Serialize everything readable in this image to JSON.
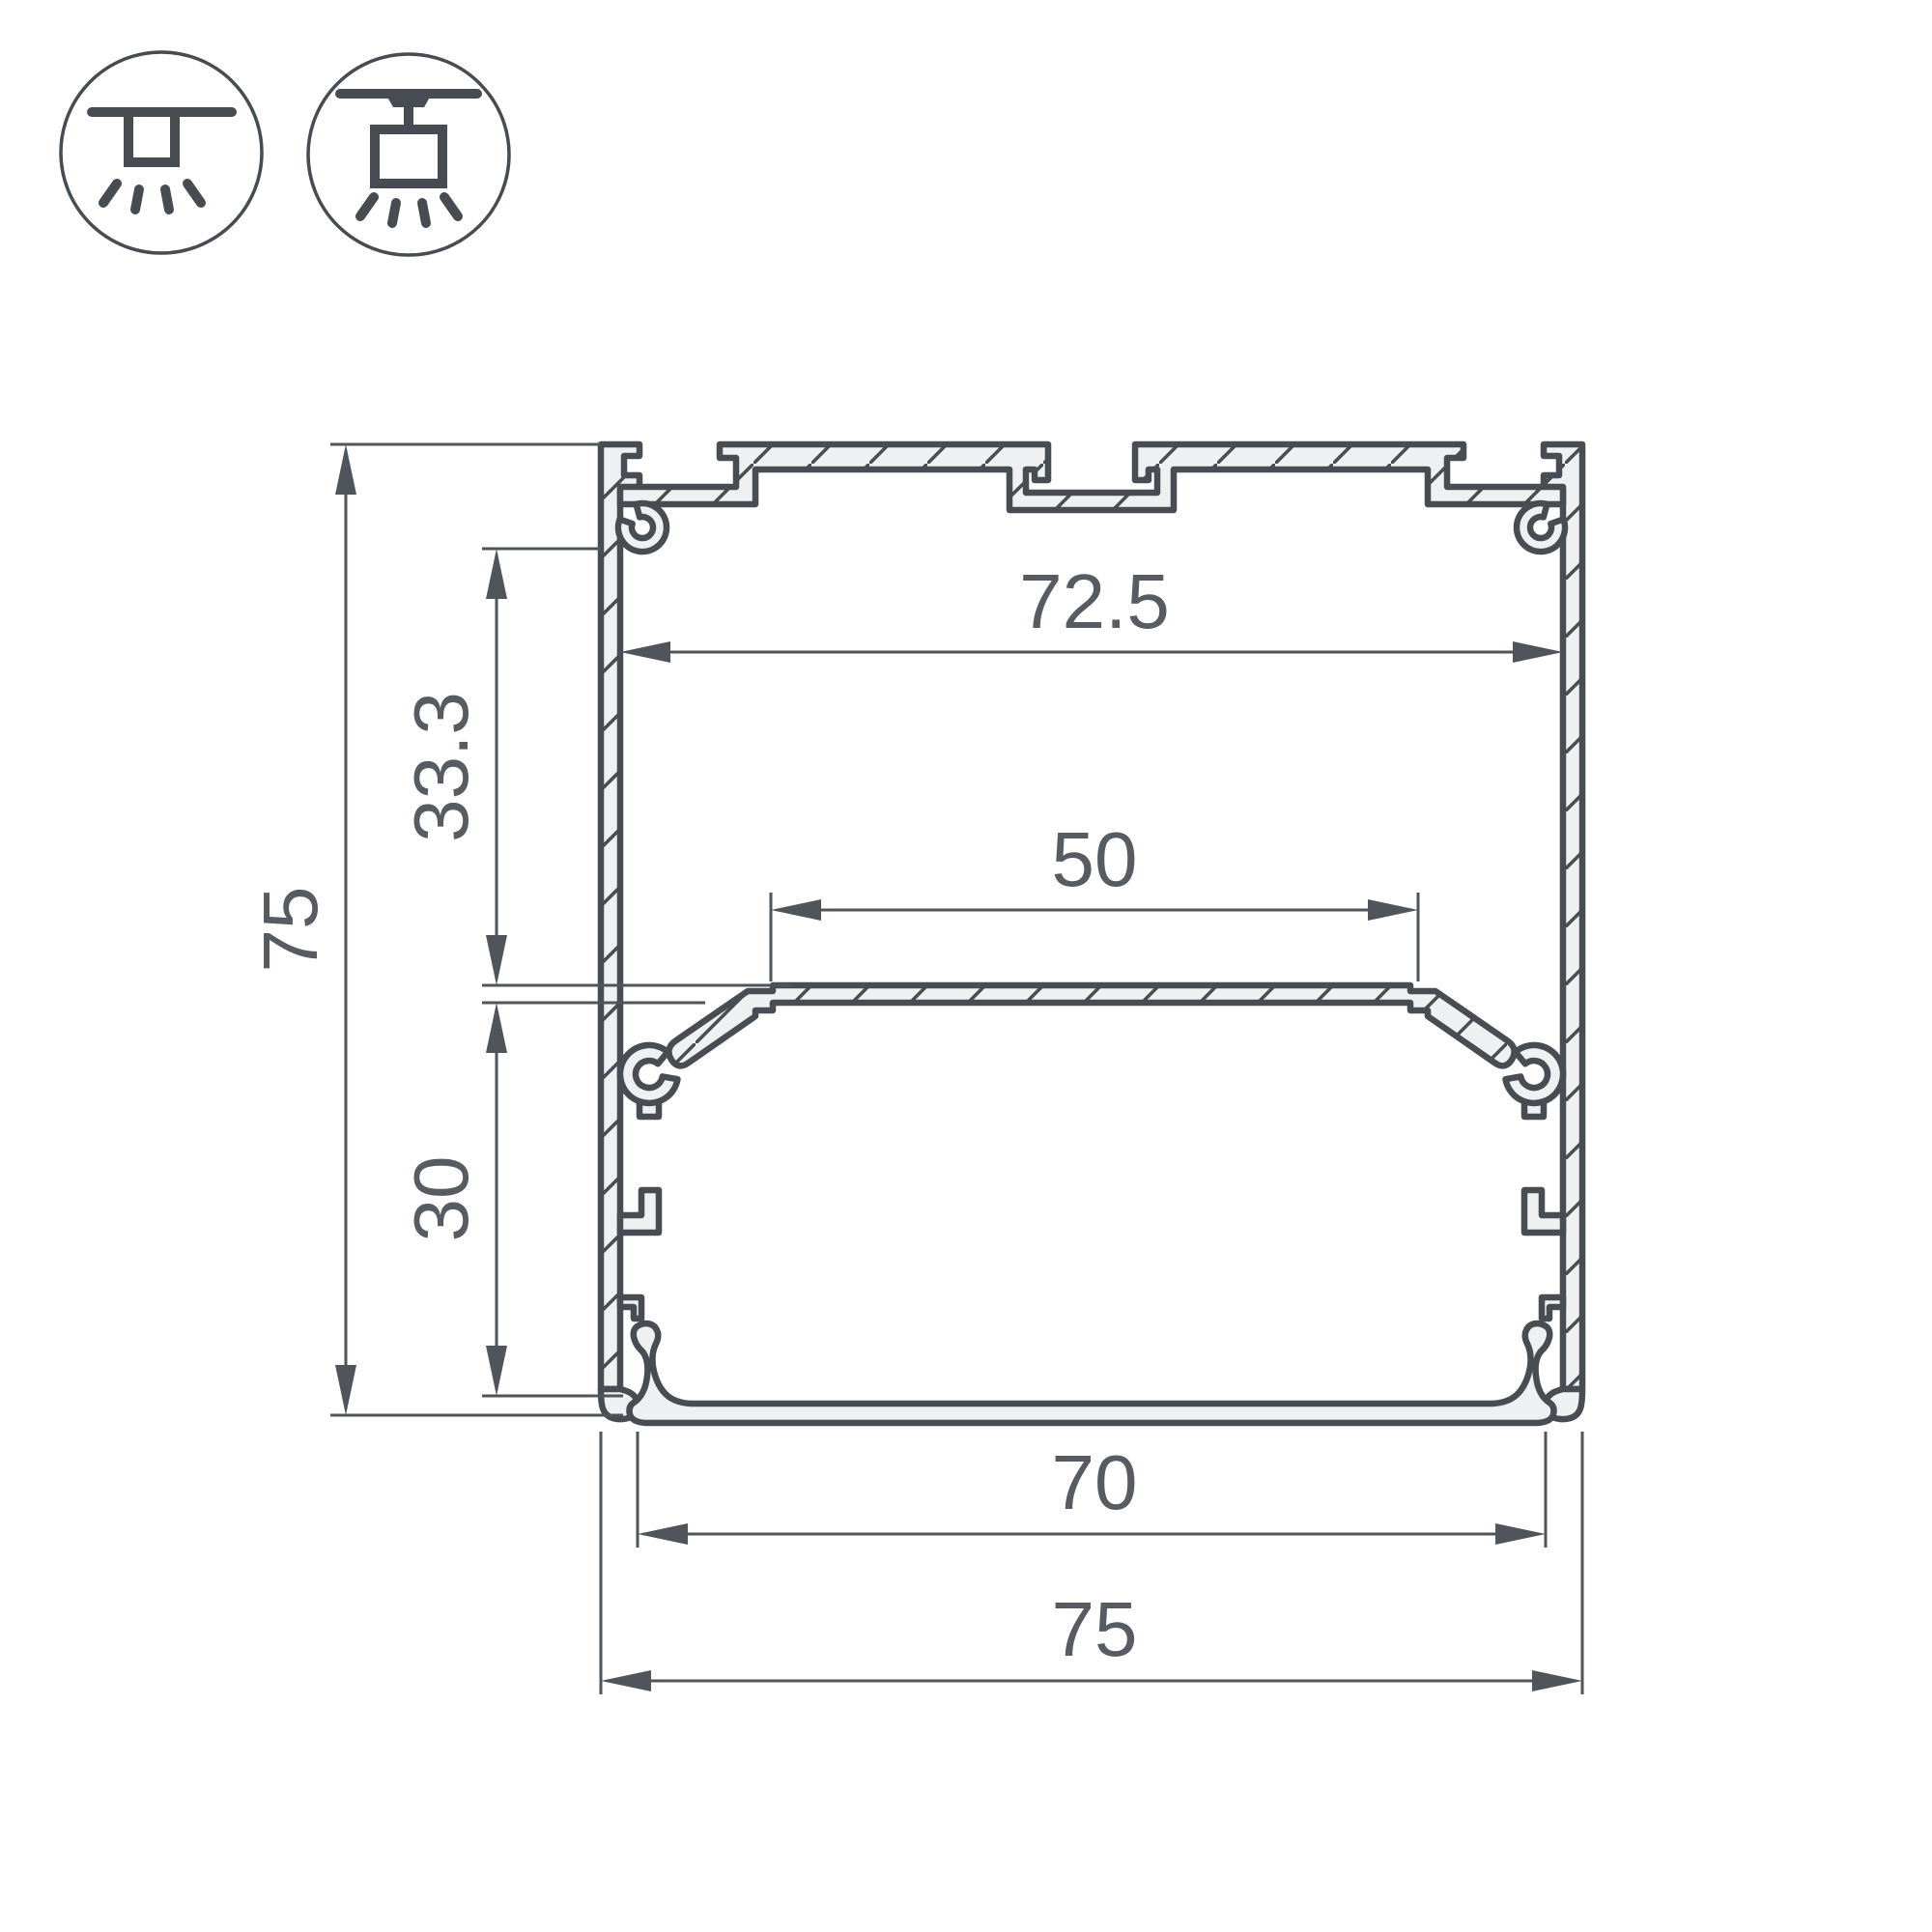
{
  "drawing": {
    "title": "led-profile-cross-section",
    "dimensions": {
      "overall_height": "75",
      "overall_width": "75",
      "inner_width": "72.5",
      "led_plate_width": "50",
      "bottom_opening_width": "70",
      "upper_chamber_depth": "33.3",
      "lower_chamber_depth": "30"
    },
    "icons": [
      {
        "name": "recessed-ceiling-mount"
      },
      {
        "name": "surface-pendant-mount"
      }
    ],
    "colors": {
      "outline": "#474D52",
      "profile_fill": "#EFF0F2",
      "dimension_lines": "#4F555B",
      "dimension_text": "#565C62",
      "background": "#FFFFFF"
    }
  }
}
